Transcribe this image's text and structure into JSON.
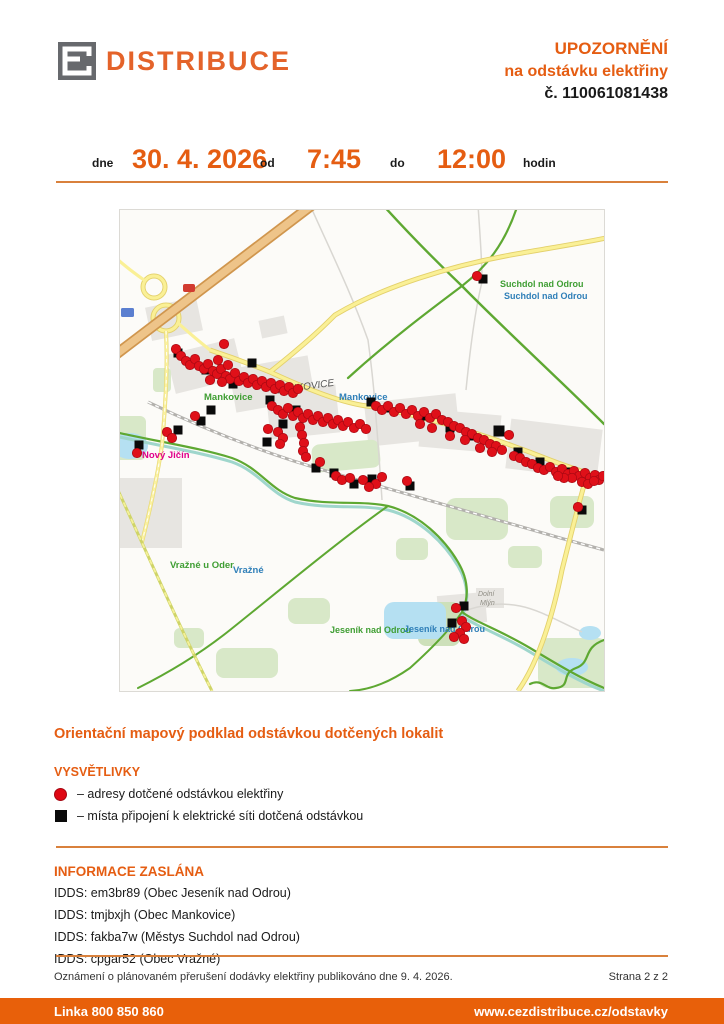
{
  "header": {
    "brand": "DISTRIBUCE",
    "title_line1": "UPOZORNĚNÍ",
    "title_line2": "na odstávku elektřiny",
    "title_line3": "č. 110061081438"
  },
  "schedule": {
    "dne_label": "dne",
    "date": "30. 4. 2026",
    "od_label": "od",
    "from_time": "7:45",
    "do_label": "do",
    "to_time": "12:00",
    "hodin_label": "hodin"
  },
  "caption": "Orientační mapový podklad odstávkou dotčených lokalit",
  "legend": {
    "title": "VYSVĚTLIVKY",
    "items": [
      {
        "symbol": "red-circle",
        "label": "– adresy dotčené odstávkou elektřiny"
      },
      {
        "symbol": "black-square",
        "label": "– místa připojení k elektrické síti dotčená odstávkou"
      }
    ]
  },
  "info": {
    "title": "INFORMACE ZASLÁNA",
    "lines": [
      "IDDS: em3br89 (Obec Jeseník nad Odrou)",
      "IDDS: tmjbxjh (Obec Mankovice)",
      "IDDS: fakba7w (Městys Suchdol nad Odrou)",
      "IDDS: cpgar52 (Obec Vražné)"
    ]
  },
  "footer": {
    "note": "Oznámení o plánovaném přerušení dodávky elektřiny publikováno dne 9. 4. 2026.",
    "page": "Strana 2 z 2",
    "phone": "Linka 800 850 860",
    "url": "www.cezdistribuce.cz/odstavky"
  },
  "map": {
    "colors": {
      "address": "#df1019",
      "address_edge": "#a50812",
      "connection": "#0a0a0a",
      "label_green": "#3f9e33",
      "label_blue": "#2f7fb8",
      "label_magenta": "#e0008a",
      "label_gray": "#555555",
      "label_minor": "#8f8d84"
    },
    "labels": [
      {
        "text": "Suchdol nad Odrou",
        "x": 380,
        "y": 77,
        "fill": "#3f9e33",
        "size": 9,
        "bold": true
      },
      {
        "text": "Suchdol nad Odrou",
        "x": 384,
        "y": 89,
        "fill": "#2f7fb8",
        "size": 9,
        "bold": true
      },
      {
        "text": "Mankovice",
        "x": 84,
        "y": 190,
        "fill": "#3f9e33",
        "size": 9.5,
        "bold": true
      },
      {
        "text": "MANKOVICE",
        "x": 155,
        "y": 184,
        "fill": "#555555",
        "size": 10,
        "bold": false,
        "italic": true,
        "rotate": -8
      },
      {
        "text": "Mankovice",
        "x": 219,
        "y": 190,
        "fill": "#2f7fb8",
        "size": 9.5,
        "bold": true
      },
      {
        "text": "Nový Jičín",
        "x": 22,
        "y": 248,
        "fill": "#e0008a",
        "size": 9.5,
        "bold": true
      },
      {
        "text": "Vražné u Oder",
        "x": 50,
        "y": 358,
        "fill": "#3f9e33",
        "size": 9.5,
        "bold": true
      },
      {
        "text": "Vražné",
        "x": 113,
        "y": 363,
        "fill": "#2f7fb8",
        "size": 9.5,
        "bold": true
      },
      {
        "text": "Jeseník nad Odrou",
        "x": 210,
        "y": 423,
        "fill": "#3f9e33",
        "size": 9,
        "bold": true
      },
      {
        "text": "Jeseník nad Odrou",
        "x": 284,
        "y": 422,
        "fill": "#2f7fb8",
        "size": 9,
        "bold": true
      },
      {
        "text": "Dolní",
        "x": 358,
        "y": 386,
        "fill": "#8f8d84",
        "size": 7,
        "italic": true
      },
      {
        "text": "Mlýn",
        "x": 360,
        "y": 395,
        "fill": "#8f8d84",
        "size": 7,
        "italic": true
      }
    ],
    "markers": {
      "connections": [
        [
          58,
          143
        ],
        [
          86,
          160
        ],
        [
          113,
          174
        ],
        [
          132,
          153
        ],
        [
          150,
          190
        ],
        [
          91,
          200
        ],
        [
          81,
          211
        ],
        [
          58,
          220
        ],
        [
          19,
          235
        ],
        [
          163,
          214
        ],
        [
          147,
          232
        ],
        [
          176,
          200
        ],
        [
          196,
          258
        ],
        [
          214,
          263
        ],
        [
          234,
          274
        ],
        [
          252,
          269
        ],
        [
          290,
          276
        ],
        [
          251,
          192
        ],
        [
          268,
          198
        ],
        [
          302,
          206
        ],
        [
          330,
          218
        ],
        [
          352,
          226
        ],
        [
          379,
          221,
          11
        ],
        [
          398,
          242
        ],
        [
          420,
          252
        ],
        [
          447,
          262
        ],
        [
          470,
          268
        ],
        [
          462,
          300
        ],
        [
          363,
          69
        ],
        [
          344,
          396
        ],
        [
          332,
          413
        ]
      ],
      "addresses": [
        [
          56,
          139
        ],
        [
          61,
          146
        ],
        [
          66,
          151
        ],
        [
          70,
          155
        ],
        [
          75,
          149
        ],
        [
          79,
          156
        ],
        [
          84,
          159
        ],
        [
          88,
          154
        ],
        [
          93,
          161
        ],
        [
          97,
          164
        ],
        [
          101,
          159
        ],
        [
          106,
          166
        ],
        [
          110,
          169
        ],
        [
          115,
          163
        ],
        [
          119,
          171
        ],
        [
          124,
          167
        ],
        [
          128,
          173
        ],
        [
          133,
          169
        ],
        [
          137,
          175
        ],
        [
          142,
          171
        ],
        [
          146,
          177
        ],
        [
          151,
          173
        ],
        [
          155,
          179
        ],
        [
          160,
          175
        ],
        [
          164,
          181
        ],
        [
          169,
          177
        ],
        [
          173,
          183
        ],
        [
          178,
          179
        ],
        [
          104,
          134
        ],
        [
          98,
          150
        ],
        [
          108,
          155
        ],
        [
          90,
          170
        ],
        [
          102,
          172
        ],
        [
          152,
          196
        ],
        [
          158,
          200
        ],
        [
          163,
          204
        ],
        [
          168,
          198
        ],
        [
          173,
          206
        ],
        [
          178,
          202
        ],
        [
          183,
          208
        ],
        [
          188,
          204
        ],
        [
          193,
          210
        ],
        [
          198,
          206
        ],
        [
          203,
          212
        ],
        [
          208,
          208
        ],
        [
          213,
          214
        ],
        [
          218,
          210
        ],
        [
          223,
          216
        ],
        [
          228,
          212
        ],
        [
          234,
          218
        ],
        [
          240,
          214
        ],
        [
          246,
          219
        ],
        [
          180,
          217
        ],
        [
          182,
          225
        ],
        [
          184,
          233
        ],
        [
          183,
          241
        ],
        [
          186,
          247
        ],
        [
          158,
          222
        ],
        [
          163,
          228
        ],
        [
          160,
          234
        ],
        [
          148,
          219
        ],
        [
          200,
          252
        ],
        [
          216,
          266
        ],
        [
          222,
          270
        ],
        [
          230,
          268
        ],
        [
          243,
          270
        ],
        [
          256,
          274
        ],
        [
          262,
          267
        ],
        [
          249,
          277
        ],
        [
          287,
          271
        ],
        [
          47,
          222
        ],
        [
          17,
          243
        ],
        [
          52,
          228
        ],
        [
          75,
          206
        ],
        [
          256,
          196
        ],
        [
          262,
          200
        ],
        [
          268,
          196
        ],
        [
          274,
          202
        ],
        [
          280,
          198
        ],
        [
          286,
          204
        ],
        [
          292,
          200
        ],
        [
          298,
          206
        ],
        [
          304,
          202
        ],
        [
          310,
          208
        ],
        [
          316,
          204
        ],
        [
          322,
          210
        ],
        [
          328,
          212
        ],
        [
          334,
          216
        ],
        [
          340,
          218
        ],
        [
          346,
          222
        ],
        [
          352,
          224
        ],
        [
          358,
          228
        ],
        [
          364,
          230
        ],
        [
          370,
          234
        ],
        [
          376,
          236
        ],
        [
          382,
          240
        ],
        [
          389,
          225
        ],
        [
          394,
          246
        ],
        [
          400,
          248
        ],
        [
          406,
          252
        ],
        [
          412,
          254
        ],
        [
          418,
          258
        ],
        [
          424,
          260
        ],
        [
          430,
          257
        ],
        [
          436,
          262
        ],
        [
          442,
          259
        ],
        [
          448,
          264
        ],
        [
          454,
          261
        ],
        [
          459,
          266
        ],
        [
          465,
          263
        ],
        [
          470,
          268
        ],
        [
          475,
          265
        ],
        [
          479,
          270
        ],
        [
          483,
          266
        ],
        [
          462,
          272
        ],
        [
          468,
          274
        ],
        [
          474,
          271
        ],
        [
          452,
          268
        ],
        [
          444,
          268
        ],
        [
          438,
          266
        ],
        [
          300,
          214
        ],
        [
          312,
          218
        ],
        [
          330,
          226
        ],
        [
          345,
          230
        ],
        [
          360,
          238
        ],
        [
          372,
          242
        ],
        [
          458,
          297
        ],
        [
          357,
          66
        ],
        [
          336,
          398
        ],
        [
          342,
          411
        ],
        [
          346,
          417
        ],
        [
          340,
          423
        ],
        [
          334,
          427
        ],
        [
          344,
          429
        ]
      ]
    }
  }
}
